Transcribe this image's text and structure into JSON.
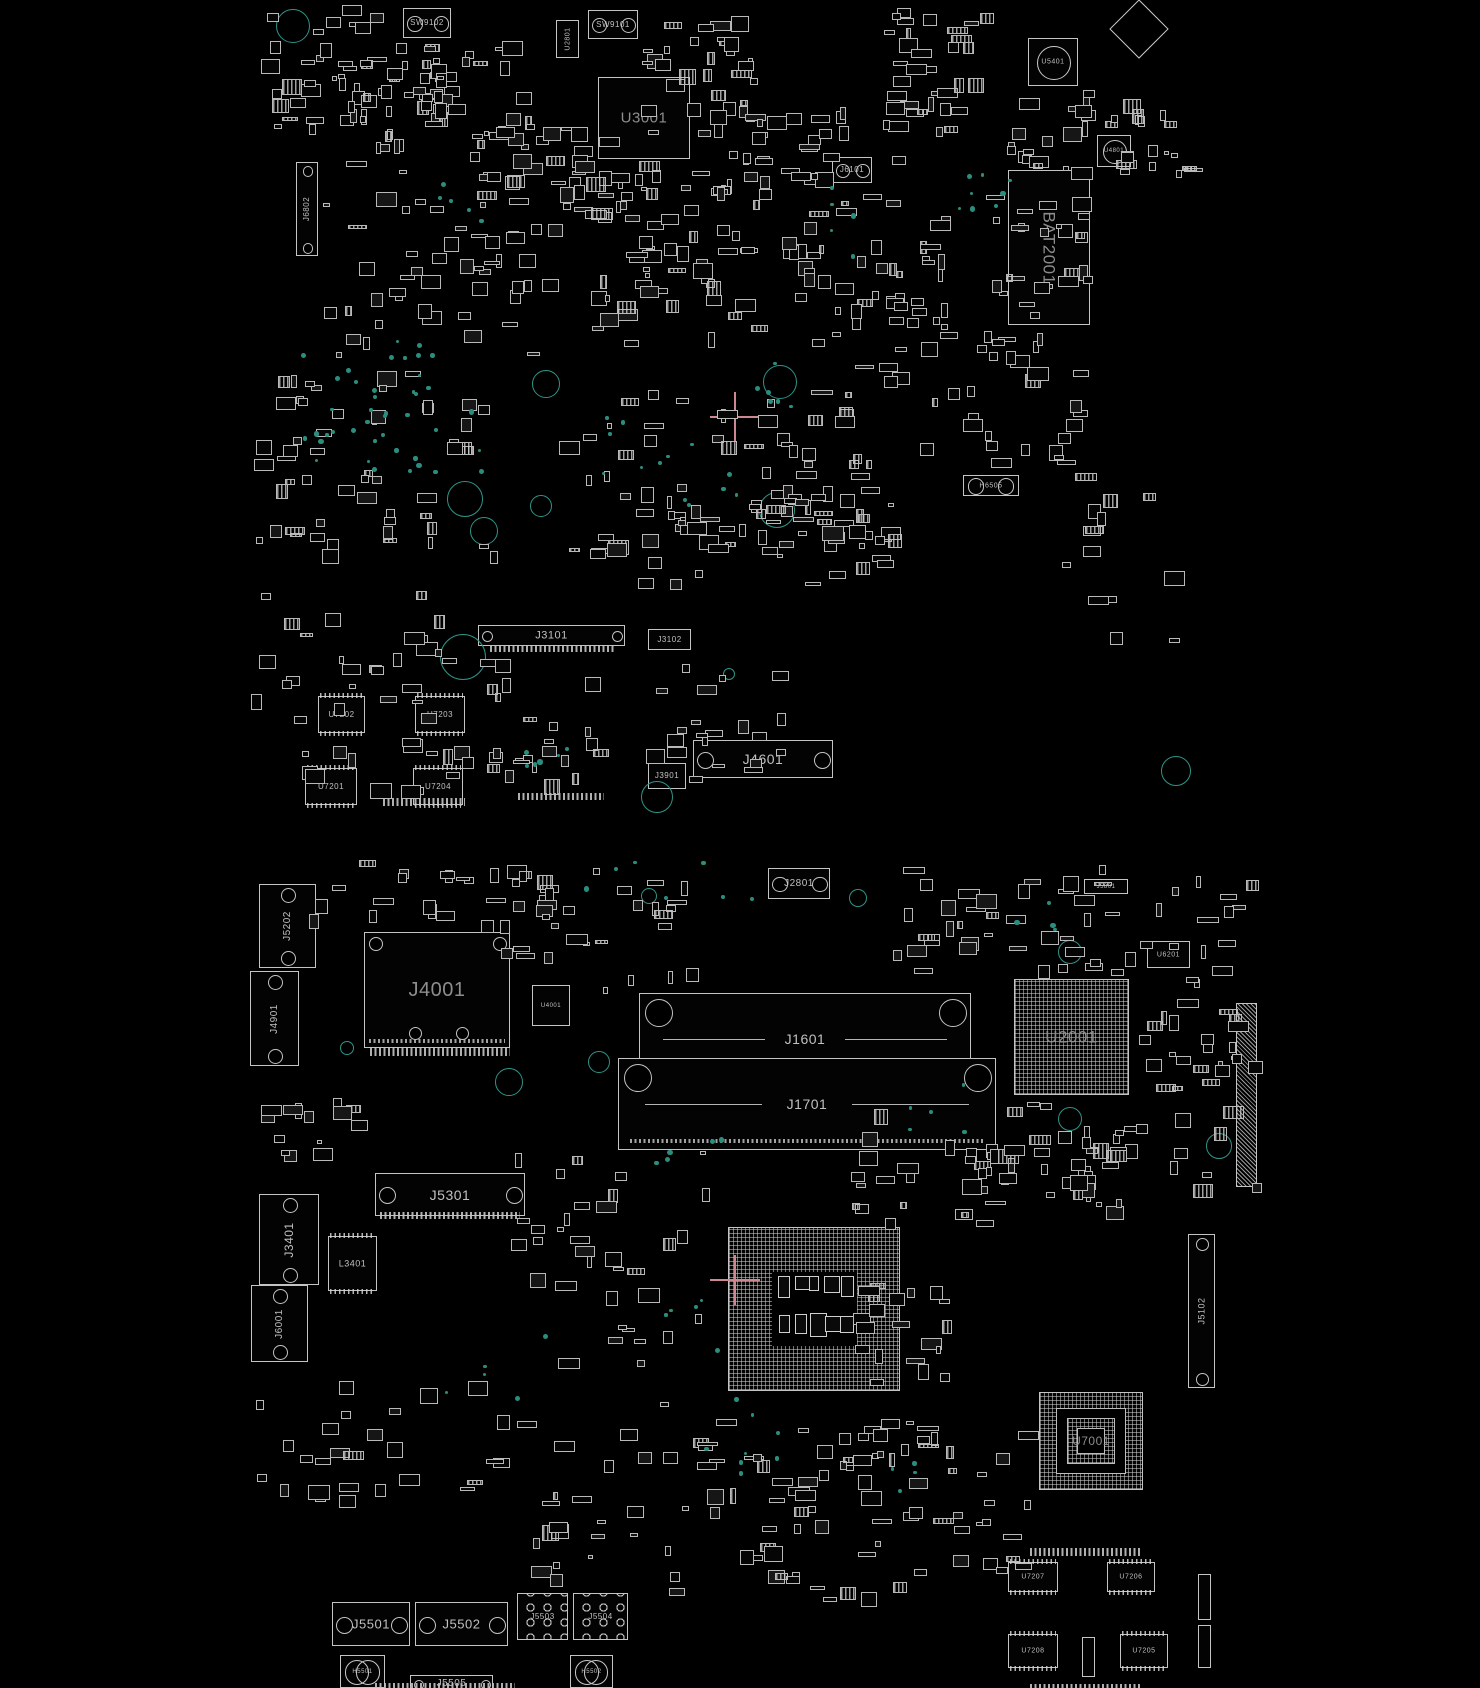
{
  "palette": {
    "background": "#000000",
    "stroke": "#c4c4c4",
    "label": "#c0c0c0",
    "big_label": "#8d8d8d",
    "teal_dot": "#2b8d7e",
    "hole_ring": "#2f9488",
    "cross": "#cd8792"
  },
  "components": [
    {
      "id": "SW9102",
      "label": "SW9102",
      "x": 403,
      "y": 8,
      "w": 48,
      "h": 30,
      "type": "conn",
      "fs": 8
    },
    {
      "id": "U2801",
      "label": "U2801",
      "x": 556,
      "y": 20,
      "w": 23,
      "h": 38,
      "type": "boxv",
      "fs": 7
    },
    {
      "id": "SW9101",
      "label": "SW9101",
      "x": 588,
      "y": 10,
      "w": 50,
      "h": 29,
      "type": "conn",
      "fs": 8
    },
    {
      "id": "U3001",
      "label": "U3001",
      "x": 598,
      "y": 77,
      "w": 92,
      "h": 82,
      "type": "box",
      "fs": 15,
      "big": true
    },
    {
      "id": "J6802",
      "label": "J6802",
      "x": 296,
      "y": 162,
      "w": 22,
      "h": 94,
      "type": "connv",
      "fs": 8
    },
    {
      "id": "J6101",
      "label": "J6101",
      "x": 832,
      "y": 157,
      "w": 40,
      "h": 26,
      "type": "conn",
      "fs": 8
    },
    {
      "id": "U5401",
      "label": "U5401",
      "x": 1028,
      "y": 38,
      "w": 50,
      "h": 48,
      "type": "circlechip",
      "fs": 7
    },
    {
      "id": "U4801",
      "label": "U4801",
      "x": 1097,
      "y": 135,
      "w": 34,
      "h": 32,
      "type": "circlechip",
      "fs": 6
    },
    {
      "id": "BAT2001",
      "label": "BAT2001",
      "x": 1008,
      "y": 170,
      "w": 82,
      "h": 155,
      "type": "boxv90",
      "fs": 17,
      "big": true
    },
    {
      "id": "H6505",
      "label": "H6505",
      "x": 963,
      "y": 475,
      "w": 56,
      "h": 21,
      "type": "hcomp",
      "fs": 7
    },
    {
      "id": "J3101",
      "label": "J3101",
      "x": 478,
      "y": 625,
      "w": 147,
      "h": 21,
      "type": "conn",
      "fs": 11
    },
    {
      "id": "J3102",
      "label": "J3102",
      "x": 648,
      "y": 629,
      "w": 43,
      "h": 21,
      "type": "box",
      "fs": 8
    },
    {
      "id": "U7202",
      "label": "U7202",
      "x": 318,
      "y": 696,
      "w": 47,
      "h": 37,
      "type": "sop",
      "fs": 8
    },
    {
      "id": "U7203",
      "label": "U7203",
      "x": 415,
      "y": 696,
      "w": 50,
      "h": 37,
      "type": "sop",
      "fs": 8
    },
    {
      "id": "U7201",
      "label": "U7201",
      "x": 305,
      "y": 768,
      "w": 52,
      "h": 37,
      "type": "sop",
      "fs": 8
    },
    {
      "id": "U7204",
      "label": "U7204",
      "x": 413,
      "y": 768,
      "w": 50,
      "h": 37,
      "type": "sop",
      "fs": 8
    },
    {
      "id": "J4601",
      "label": "J4601",
      "x": 693,
      "y": 740,
      "w": 140,
      "h": 38,
      "type": "conn",
      "fs": 14
    },
    {
      "id": "J3901",
      "label": "J3901",
      "x": 648,
      "y": 763,
      "w": 38,
      "h": 26,
      "type": "box",
      "fs": 8
    },
    {
      "id": "J2801",
      "label": "J2801",
      "x": 768,
      "y": 868,
      "w": 62,
      "h": 31,
      "type": "conn",
      "fs": 10
    },
    {
      "id": "J5801",
      "label": "J5801",
      "x": 1084,
      "y": 879,
      "w": 44,
      "h": 15,
      "type": "box",
      "fs": 6
    },
    {
      "id": "U6201",
      "label": "U6201",
      "x": 1147,
      "y": 941,
      "w": 43,
      "h": 27,
      "type": "box",
      "fs": 7
    },
    {
      "id": "J5202",
      "label": "J5202",
      "x": 259,
      "y": 884,
      "w": 57,
      "h": 84,
      "type": "connv",
      "fs": 10
    },
    {
      "id": "J4901",
      "label": "J4901",
      "x": 250,
      "y": 971,
      "w": 49,
      "h": 95,
      "type": "connv",
      "fs": 10
    },
    {
      "id": "J4001",
      "label": "J4001",
      "x": 364,
      "y": 932,
      "w": 146,
      "h": 116,
      "type": "module",
      "fs": 20,
      "big": true
    },
    {
      "id": "U4001",
      "label": "U4001",
      "x": 532,
      "y": 985,
      "w": 38,
      "h": 41,
      "type": "box",
      "fs": 6
    },
    {
      "id": "J1601",
      "label": "J1601",
      "x": 639,
      "y": 993,
      "w": 332,
      "h": 91,
      "type": "dimm",
      "fs": 14
    },
    {
      "id": "J1701",
      "label": "J1701",
      "x": 618,
      "y": 1058,
      "w": 378,
      "h": 92,
      "type": "dimm",
      "fs": 14
    },
    {
      "id": "U2001",
      "label": "U2001",
      "x": 1014,
      "y": 979,
      "w": 115,
      "h": 116,
      "type": "bga",
      "fs": 17,
      "big": true
    },
    {
      "id": "J5301",
      "label": "J5301",
      "x": 375,
      "y": 1173,
      "w": 150,
      "h": 43,
      "type": "conn",
      "fs": 14
    },
    {
      "id": "J3401",
      "label": "J3401",
      "x": 259,
      "y": 1194,
      "w": 60,
      "h": 91,
      "type": "connv",
      "fs": 12
    },
    {
      "id": "L3401",
      "label": "L3401",
      "x": 328,
      "y": 1236,
      "w": 49,
      "h": 55,
      "type": "sop",
      "fs": 9
    },
    {
      "id": "J6001",
      "label": "J6001",
      "x": 251,
      "y": 1285,
      "w": 57,
      "h": 77,
      "type": "connv",
      "fs": 10
    },
    {
      "id": "J5102",
      "label": "J5102",
      "x": 1188,
      "y": 1234,
      "w": 27,
      "h": 154,
      "type": "connv",
      "fs": 9
    },
    {
      "id": "cpu-socket",
      "label": "",
      "x": 728,
      "y": 1227,
      "w": 172,
      "h": 164,
      "type": "bgacavity",
      "fs": 0
    },
    {
      "id": "U7001",
      "label": "U7001",
      "x": 1039,
      "y": 1392,
      "w": 104,
      "h": 98,
      "type": "bgarings",
      "fs": 12,
      "big": true
    },
    {
      "id": "U7207",
      "label": "U7207",
      "x": 1008,
      "y": 1562,
      "w": 50,
      "h": 30,
      "type": "sop",
      "fs": 7
    },
    {
      "id": "U7206",
      "label": "U7206",
      "x": 1107,
      "y": 1562,
      "w": 48,
      "h": 30,
      "type": "sop",
      "fs": 7
    },
    {
      "id": "U7208",
      "label": "U7208",
      "x": 1008,
      "y": 1634,
      "w": 50,
      "h": 34,
      "type": "sop",
      "fs": 7
    },
    {
      "id": "U7205",
      "label": "U7205",
      "x": 1120,
      "y": 1634,
      "w": 48,
      "h": 34,
      "type": "sop",
      "fs": 7
    },
    {
      "id": "J5501",
      "label": "J5501",
      "x": 332,
      "y": 1602,
      "w": 78,
      "h": 44,
      "type": "conn",
      "fs": 13
    },
    {
      "id": "J5502",
      "label": "J5502",
      "x": 415,
      "y": 1602,
      "w": 93,
      "h": 44,
      "type": "conn",
      "fs": 13
    },
    {
      "id": "J5503",
      "label": "J5503",
      "x": 517,
      "y": 1593,
      "w": 51,
      "h": 47,
      "type": "holesconn",
      "fs": 8
    },
    {
      "id": "J5504",
      "label": "J5504",
      "x": 573,
      "y": 1593,
      "w": 55,
      "h": 47,
      "type": "holesconn",
      "fs": 8
    },
    {
      "id": "J5505",
      "label": "J5505",
      "x": 410,
      "y": 1675,
      "w": 83,
      "h": 18,
      "type": "conn",
      "fs": 10
    },
    {
      "id": "H5501",
      "label": "H5501",
      "x": 340,
      "y": 1655,
      "w": 45,
      "h": 33,
      "type": "hcomp",
      "fs": 6
    },
    {
      "id": "H5502",
      "label": "H5502",
      "x": 570,
      "y": 1655,
      "w": 43,
      "h": 33,
      "type": "hcomp",
      "fs": 6
    },
    {
      "id": "edge-connector",
      "label": "",
      "x": 1236,
      "y": 1003,
      "w": 21,
      "h": 184,
      "type": "hatch",
      "fs": 0
    },
    {
      "id": "vchip-1",
      "label": "",
      "x": 1198,
      "y": 1574,
      "w": 13,
      "h": 46,
      "type": "box",
      "fs": 0
    },
    {
      "id": "vchip-2",
      "label": "",
      "x": 1198,
      "y": 1625,
      "w": 13,
      "h": 43,
      "type": "box",
      "fs": 0
    },
    {
      "id": "vchip-3",
      "label": "",
      "x": 1082,
      "y": 1637,
      "w": 13,
      "h": 40,
      "type": "box",
      "fs": 0
    },
    {
      "id": "diamond-mark",
      "label": "",
      "x": 1118,
      "y": 8,
      "w": 40,
      "h": 40,
      "type": "diamond",
      "fs": 0
    },
    {
      "id": "pinrow-1",
      "label": "",
      "x": 490,
      "y": 646,
      "w": 125,
      "h": 6,
      "type": "pinrow",
      "fs": 0
    },
    {
      "id": "pinrow-2",
      "label": "",
      "x": 383,
      "y": 798,
      "w": 82,
      "h": 8,
      "type": "pinrow",
      "fs": 0
    },
    {
      "id": "pinrow-3",
      "label": "",
      "x": 518,
      "y": 793,
      "w": 86,
      "h": 7,
      "type": "pinrow",
      "fs": 0
    },
    {
      "id": "pinrow-4",
      "label": "",
      "x": 370,
      "y": 1048,
      "w": 140,
      "h": 8,
      "type": "pinrow",
      "fs": 0
    },
    {
      "id": "pinrow-5",
      "label": "",
      "x": 380,
      "y": 1212,
      "w": 140,
      "h": 7,
      "type": "pinrow",
      "fs": 0
    },
    {
      "id": "pinrow-6",
      "label": "",
      "x": 375,
      "y": 1683,
      "w": 140,
      "h": 5,
      "type": "pinrow",
      "fs": 0
    },
    {
      "id": "pinrow-7",
      "label": "",
      "x": 1030,
      "y": 1548,
      "w": 110,
      "h": 8,
      "type": "pinrow",
      "fs": 0
    },
    {
      "id": "pinrow-8",
      "label": "",
      "x": 1030,
      "y": 1684,
      "w": 110,
      "h": 4,
      "type": "pinrow",
      "fs": 0
    }
  ],
  "mount_holes": [
    [
      293,
      26,
      17
    ],
    [
      546,
      384,
      14
    ],
    [
      780,
      382,
      17
    ],
    [
      465,
      499,
      18
    ],
    [
      541,
      506,
      11
    ],
    [
      484,
      531,
      14
    ],
    [
      777,
      510,
      18
    ],
    [
      463,
      657,
      23
    ],
    [
      729,
      674,
      6
    ],
    [
      657,
      797,
      16
    ],
    [
      1176,
      771,
      15
    ],
    [
      649,
      896,
      8
    ],
    [
      858,
      898,
      9
    ],
    [
      1070,
      952,
      12
    ],
    [
      1070,
      1119,
      12
    ],
    [
      509,
      1082,
      14
    ],
    [
      347,
      1048,
      7
    ],
    [
      599,
      1062,
      11
    ],
    [
      1219,
      1146,
      13
    ]
  ],
  "fiducial_crosses": [
    {
      "cx": 735,
      "cy": 417,
      "arm": 25
    },
    {
      "cx": 735,
      "cy": 1280,
      "arm": 25
    }
  ],
  "smd_clusters": [
    [
      260,
      5,
      150,
      140,
      40,
      11
    ],
    [
      330,
      60,
      130,
      120,
      30,
      12
    ],
    [
      420,
      40,
      120,
      110,
      30,
      13
    ],
    [
      470,
      120,
      200,
      90,
      35,
      14
    ],
    [
      640,
      10,
      120,
      130,
      30,
      15
    ],
    [
      700,
      100,
      150,
      100,
      30,
      16
    ],
    [
      880,
      5,
      120,
      160,
      35,
      17
    ],
    [
      1000,
      80,
      100,
      100,
      20,
      18
    ],
    [
      1090,
      40,
      120,
      140,
      20,
      19
    ],
    [
      320,
      190,
      250,
      170,
      50,
      21
    ],
    [
      560,
      170,
      330,
      130,
      45,
      22
    ],
    [
      590,
      230,
      180,
      120,
      25,
      23
    ],
    [
      790,
      190,
      170,
      170,
      40,
      24
    ],
    [
      980,
      190,
      120,
      140,
      25,
      25
    ],
    [
      920,
      330,
      170,
      150,
      30,
      26
    ],
    [
      250,
      370,
      250,
      200,
      55,
      27
    ],
    [
      540,
      390,
      330,
      170,
      55,
      28
    ],
    [
      610,
      480,
      280,
      110,
      35,
      29
    ],
    [
      250,
      590,
      210,
      170,
      30,
      31
    ],
    [
      480,
      655,
      310,
      130,
      35,
      32
    ],
    [
      800,
      360,
      110,
      210,
      22,
      33
    ],
    [
      1060,
      470,
      130,
      190,
      14,
      34
    ],
    [
      290,
      745,
      280,
      55,
      22,
      35
    ],
    [
      300,
      860,
      270,
      70,
      25,
      41
    ],
    [
      480,
      865,
      220,
      130,
      30,
      42
    ],
    [
      890,
      860,
      250,
      120,
      40,
      43
    ],
    [
      1130,
      860,
      130,
      240,
      28,
      44
    ],
    [
      510,
      1150,
      210,
      240,
      35,
      45
    ],
    [
      850,
      1100,
      300,
      130,
      45,
      46
    ],
    [
      620,
      1400,
      290,
      200,
      40,
      47
    ],
    [
      900,
      1395,
      150,
      190,
      28,
      48
    ],
    [
      250,
      1380,
      300,
      130,
      28,
      49
    ],
    [
      1160,
      1000,
      110,
      200,
      18,
      51
    ],
    [
      530,
      1440,
      90,
      150,
      15,
      52
    ],
    [
      750,
      1440,
      150,
      170,
      25,
      53
    ],
    [
      250,
      1090,
      120,
      80,
      15,
      54
    ],
    [
      850,
      1280,
      120,
      110,
      20,
      55
    ],
    [
      950,
      1140,
      180,
      90,
      20,
      56
    ]
  ],
  "via_dot_clusters": [
    [
      295,
      325,
      140,
      140,
      30,
      61
    ],
    [
      360,
      395,
      120,
      90,
      12,
      62
    ],
    [
      600,
      415,
      100,
      60,
      8,
      63
    ],
    [
      745,
      360,
      50,
      45,
      6,
      64
    ],
    [
      945,
      165,
      65,
      45,
      8,
      65
    ],
    [
      830,
      185,
      35,
      80,
      5,
      66
    ],
    [
      490,
      745,
      110,
      25,
      6,
      67
    ],
    [
      560,
      860,
      190,
      50,
      7,
      68
    ],
    [
      640,
      1110,
      80,
      60,
      5,
      69
    ],
    [
      690,
      1380,
      90,
      110,
      8,
      71
    ],
    [
      660,
      1290,
      60,
      70,
      5,
      72
    ],
    [
      900,
      1080,
      70,
      50,
      5,
      73
    ],
    [
      1010,
      888,
      60,
      40,
      4,
      74
    ],
    [
      440,
      1330,
      110,
      70,
      5,
      75
    ],
    [
      855,
      1440,
      60,
      60,
      4,
      76
    ],
    [
      680,
      470,
      60,
      40,
      5,
      77
    ],
    [
      420,
      180,
      60,
      40,
      5,
      78
    ]
  ]
}
